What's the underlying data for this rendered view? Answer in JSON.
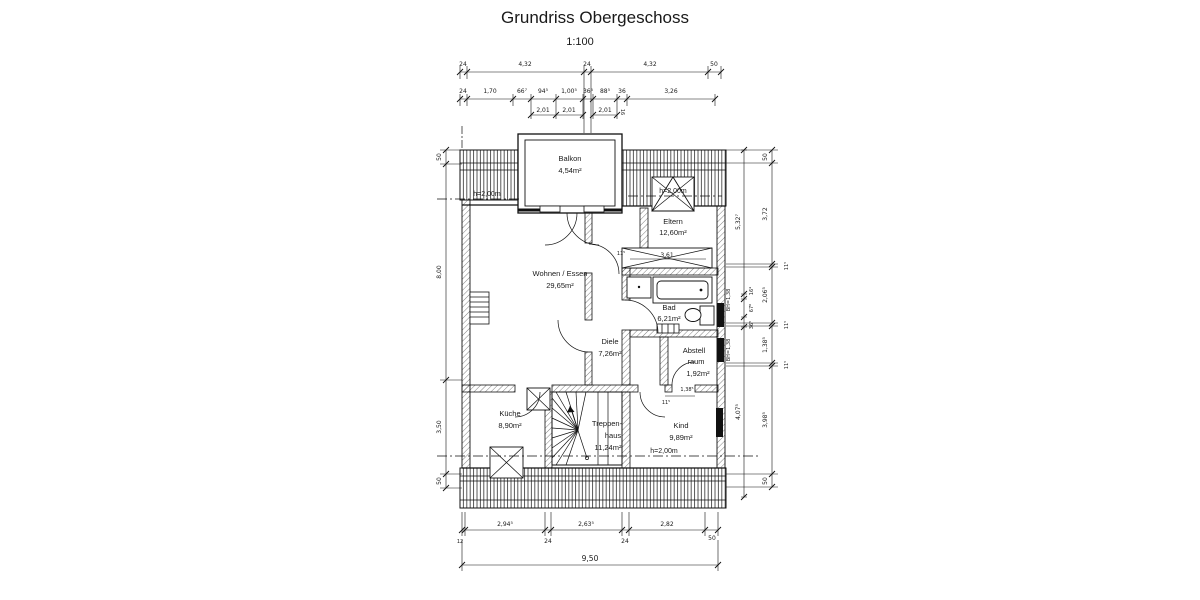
{
  "title": "Grundriss Obergeschoss",
  "scale_label": "1:100",
  "rooms": {
    "balkon": {
      "name": "Balkon",
      "area": "4,54m²"
    },
    "eltern": {
      "name": "Eltern",
      "area": "12,60m²"
    },
    "wohnen_essen": {
      "name": "Wohnen / Essen",
      "area": "29,65m²"
    },
    "bad": {
      "name": "Bad",
      "area": "6,21m²"
    },
    "diele": {
      "name": "Diele",
      "area": "7,26m²"
    },
    "abstellraum": {
      "line1": "Abstell",
      "line2": "raum",
      "area": "1,92m²"
    },
    "kueche": {
      "name": "Küche",
      "area": "8,90m²"
    },
    "treppenhaus": {
      "line1": "Treppen-",
      "line2": "haus",
      "area": "11,24m²"
    },
    "kind": {
      "name": "Kind",
      "area": "9,89m²"
    }
  },
  "height_labels": {
    "left": "h=2,00m",
    "right_top": "h=2,00m",
    "bottom": "h=2,00m"
  },
  "dim_top_row1": [
    "24",
    "4,32",
    "24",
    "4,32",
    "50"
  ],
  "dim_top_row2": [
    "24",
    "1,70",
    "66⁷",
    "94⁵",
    "1,00⁵",
    "36⁵",
    "88⁵",
    "36",
    "3,26"
  ],
  "dim_top_sub": [
    "2,01",
    "2,01",
    "2,01",
    "16"
  ],
  "dim_bottom_row": [
    "2,94⁵",
    "2,63⁵",
    "2,82"
  ],
  "dim_bottom_small": [
    "12",
    "24",
    "24",
    "50"
  ],
  "dim_bottom_total": "9,50",
  "dim_left": [
    "50",
    "8,00",
    "3,50",
    "50"
  ],
  "dim_right_outer": [
    "50",
    "3,72",
    "11⁵",
    "2,06⁵",
    "11⁵",
    "1,38⁵",
    "11⁵",
    "3,98⁵",
    "50"
  ],
  "dim_right_inner": [
    "5,32⁷",
    "16⁴",
    "67⁶",
    "36⁵",
    "4,07⁵"
  ],
  "window_sill_labels": [
    "BH=1,38",
    "BH=1,38"
  ],
  "dim_interior": {
    "closet_width": "3,61",
    "closet_wall": "11⁵",
    "kind_door": "1,38⁵",
    "kind_door_wall": "11⁵"
  }
}
